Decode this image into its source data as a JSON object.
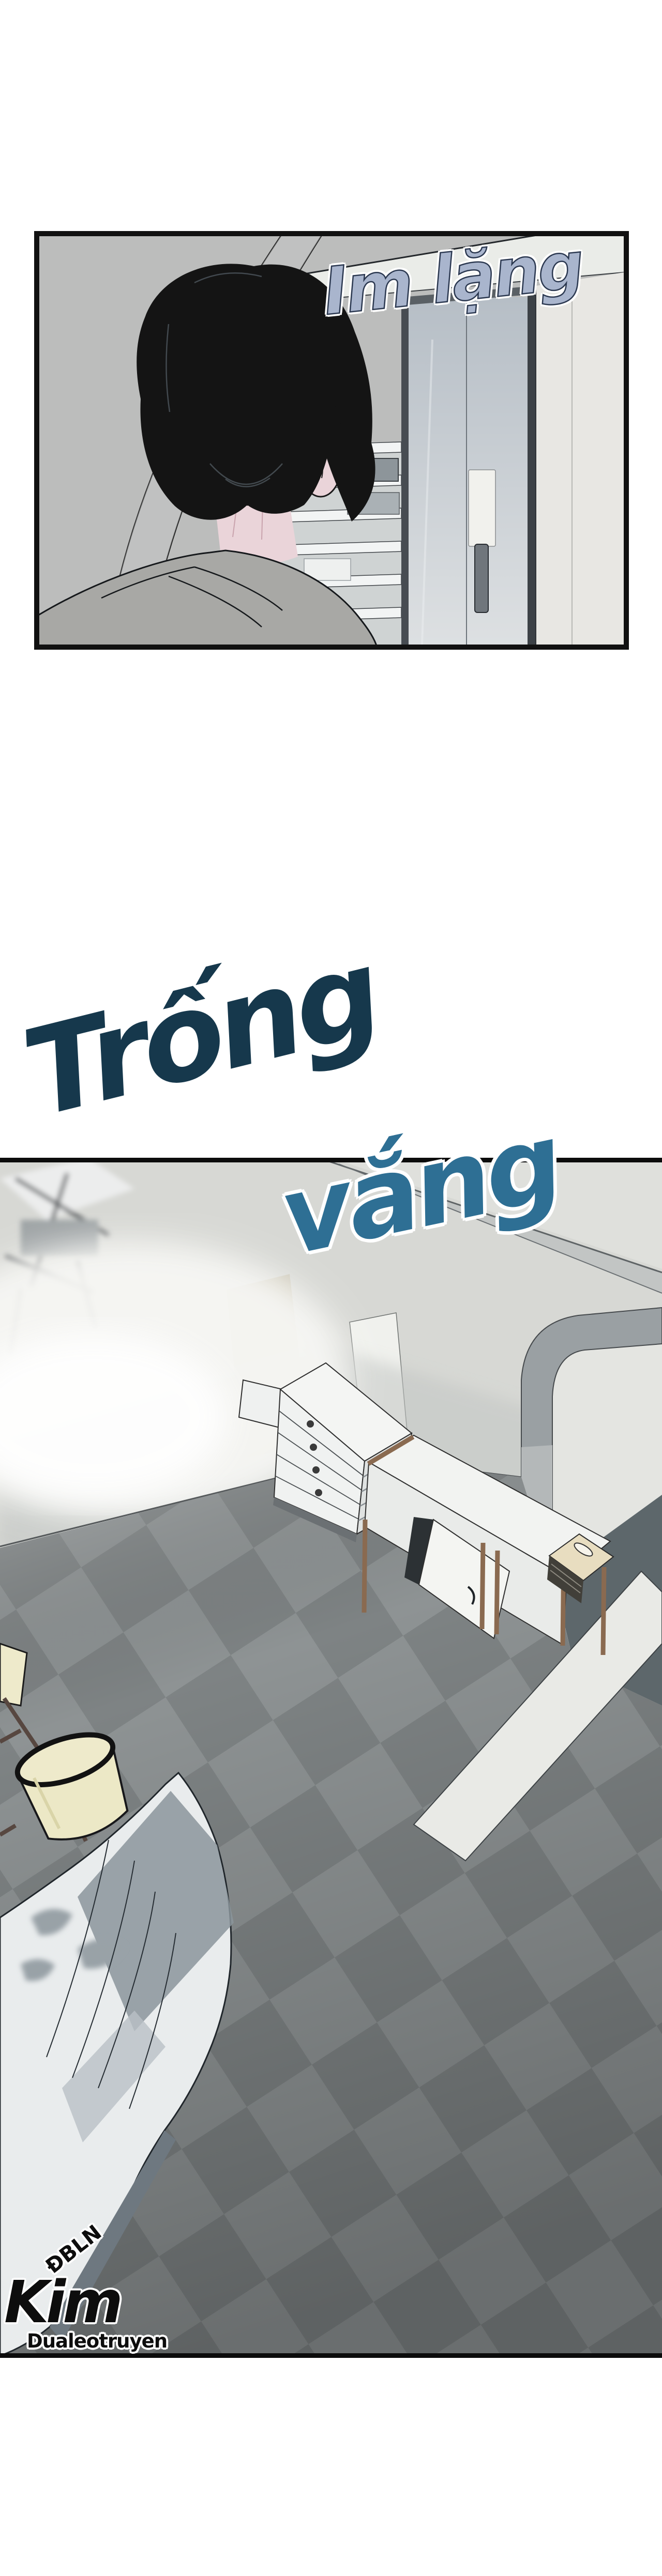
{
  "panel1": {
    "sfx": "Im lặng"
  },
  "panel2": {
    "title_line1": "Trống",
    "title_line2": "vắng"
  },
  "watermark": {
    "tag": "ĐBLN",
    "name": "Kim",
    "group": "Dualeotruyen"
  },
  "colors": {
    "page_bg": "#ffffff",
    "panel_border": "#111111",
    "sfx_fill": "#a9b5cd",
    "sfx_outline": "#2b3850",
    "title1_fill": "#16384c",
    "title2_fill": "#2e6f94",
    "wall_grey": "#bcbdbc",
    "scene_wall": "#d7d8d4",
    "floor_tile_light": "#8e9394",
    "floor_tile_dark": "#7e8384",
    "hall_floor": "#5d676b",
    "bed_white": "#e9eced",
    "lamp_shade": "#eeeacb",
    "wood_trim": "#8a6a50",
    "hair_black": "#141414",
    "skin_pink": "#ead4d9",
    "shirt_grey": "#a8a8a5",
    "watermark_ink": "#0d0d0d"
  }
}
